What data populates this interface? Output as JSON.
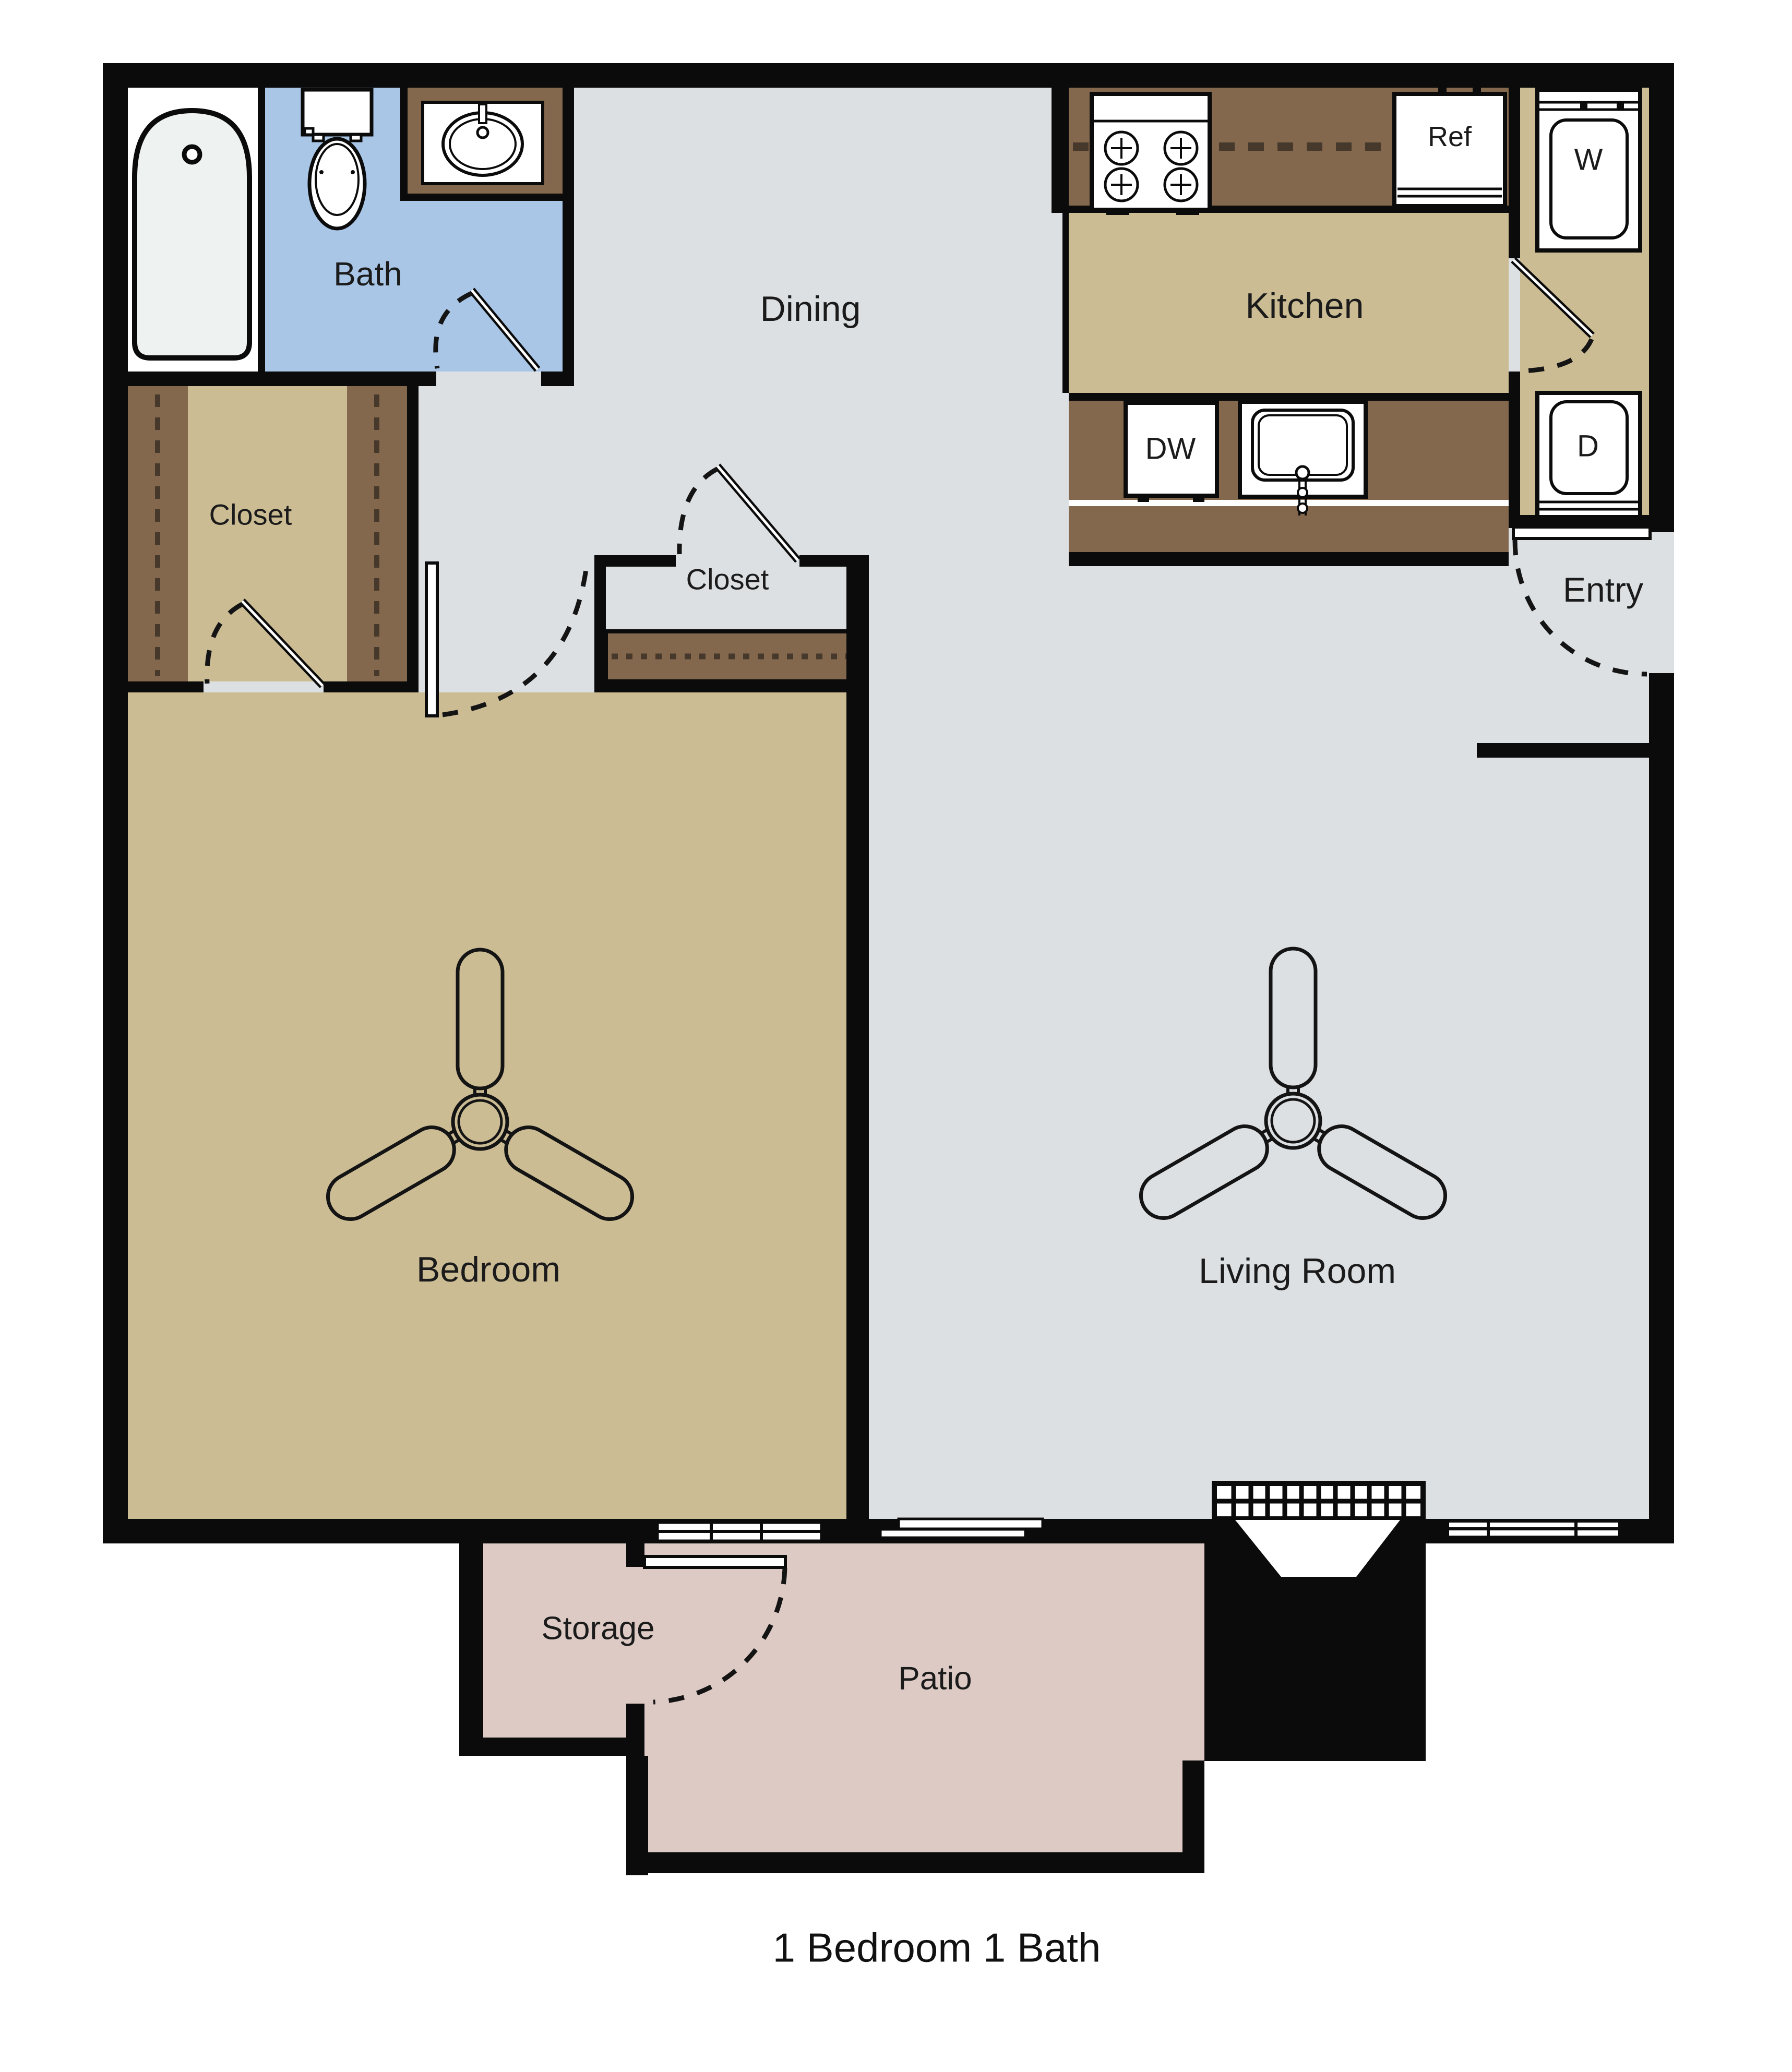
{
  "title": "1 Bedroom 1 Bath",
  "rooms": {
    "bath": "Bath",
    "dining": "Dining",
    "kitchen": "Kitchen",
    "entry": "Entry",
    "closet_left": "Closet",
    "closet_hall": "Closet",
    "bedroom": "Bedroom",
    "living_room": "Living Room",
    "storage": "Storage",
    "patio": "Patio"
  },
  "appliances": {
    "refrigerator": "Ref",
    "washer": "W",
    "dryer": "D",
    "dishwasher": "DW"
  },
  "icons": [
    "bathtub-icon",
    "toilet-icon",
    "bath-sink-icon",
    "stove-icon",
    "kitchen-sink-icon",
    "ceiling-fan-icon",
    "fireplace-icon",
    "window-icon",
    "sliding-door-icon",
    "door-swing-icon"
  ],
  "colors": {
    "wall": "#0b0b0b",
    "floor_gray": "#dce0e3",
    "floor_tan": "#cbbc94",
    "cabinet_brown": "#84684e",
    "bath_blue": "#a9c6e7",
    "patio_pink": "#ddcac4",
    "tub_fill": "#eef3f1",
    "white": "#ffffff"
  }
}
